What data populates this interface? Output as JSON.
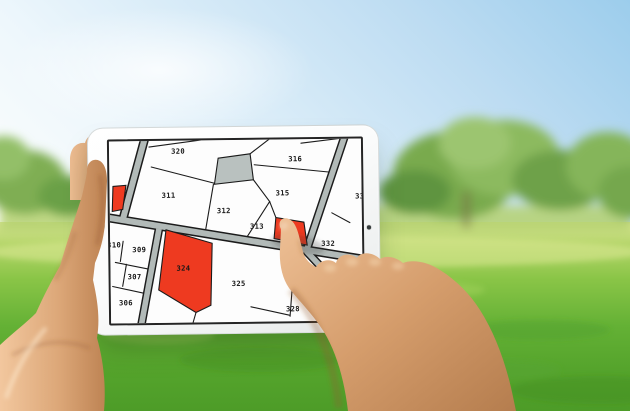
{
  "map": {
    "selected_parcel": "314",
    "parcels": [
      {
        "label": "320"
      },
      {
        "label": "316"
      },
      {
        "label": "311"
      },
      {
        "label": "312"
      },
      {
        "label": "315"
      },
      {
        "label": "313"
      },
      {
        "label": "314",
        "highlighted": true,
        "state": "selected"
      },
      {
        "label": "332"
      },
      {
        "label": "331",
        "partially_visible": true
      },
      {
        "label": "310",
        "partially_visible": true
      },
      {
        "label": "309"
      },
      {
        "label": "307"
      },
      {
        "label": "306"
      },
      {
        "label": "324",
        "highlighted": true
      },
      {
        "label": "325"
      },
      {
        "label": "328"
      }
    ],
    "unlabeled_parcels": [
      {
        "id": "gray-reserved-parcel",
        "fill": "#b9c1bf"
      },
      {
        "id": "left-edge-red-parcel",
        "fill": "#ee3a20"
      }
    ],
    "colors": {
      "parcel_background": "#fdfdfd",
      "boundary": "#1b1b1b",
      "road_fill": "#b2bab8",
      "highlight_red": "#ee3a20",
      "reserved_gray": "#b9c1bf",
      "screen_frame": "#242424"
    }
  },
  "background": {
    "sky_top": "#9ccdec",
    "grass_main": "#64b135",
    "trees_main": "#79aa4e",
    "bezel": "#f4f5f4",
    "skin_tone": "#dca778"
  }
}
